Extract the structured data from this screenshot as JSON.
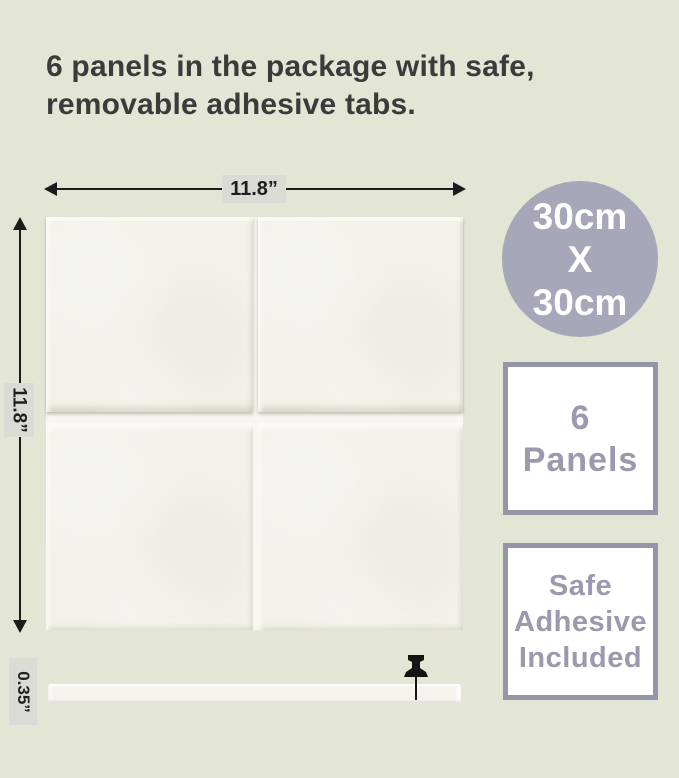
{
  "colors": {
    "background": "#e3e5d5",
    "headline_text": "#3b3b3b",
    "dimension_line": "#1c1c1c",
    "dimension_label_bg": "#dadbd4",
    "size_badge_bg": "#a7a7ba",
    "size_badge_text": "#ffffff",
    "info_badge_border": "#9595a9",
    "info_badge_text": "#9a99ae",
    "panel_color": "#f2f1ea"
  },
  "headline": {
    "line1": "6 panels in the package with safe,",
    "line2": "removable adhesive tabs."
  },
  "dimensions": {
    "width": "11.8”",
    "height": "11.8”",
    "thickness": "0.35”"
  },
  "badges": {
    "size": {
      "line1": "30cm",
      "line2": "X",
      "line3": "30cm"
    },
    "count": {
      "line1": "6",
      "line2": "Panels"
    },
    "adhesive": {
      "line1": "Safe",
      "line2": "Adhesive",
      "line3": "Included"
    }
  }
}
